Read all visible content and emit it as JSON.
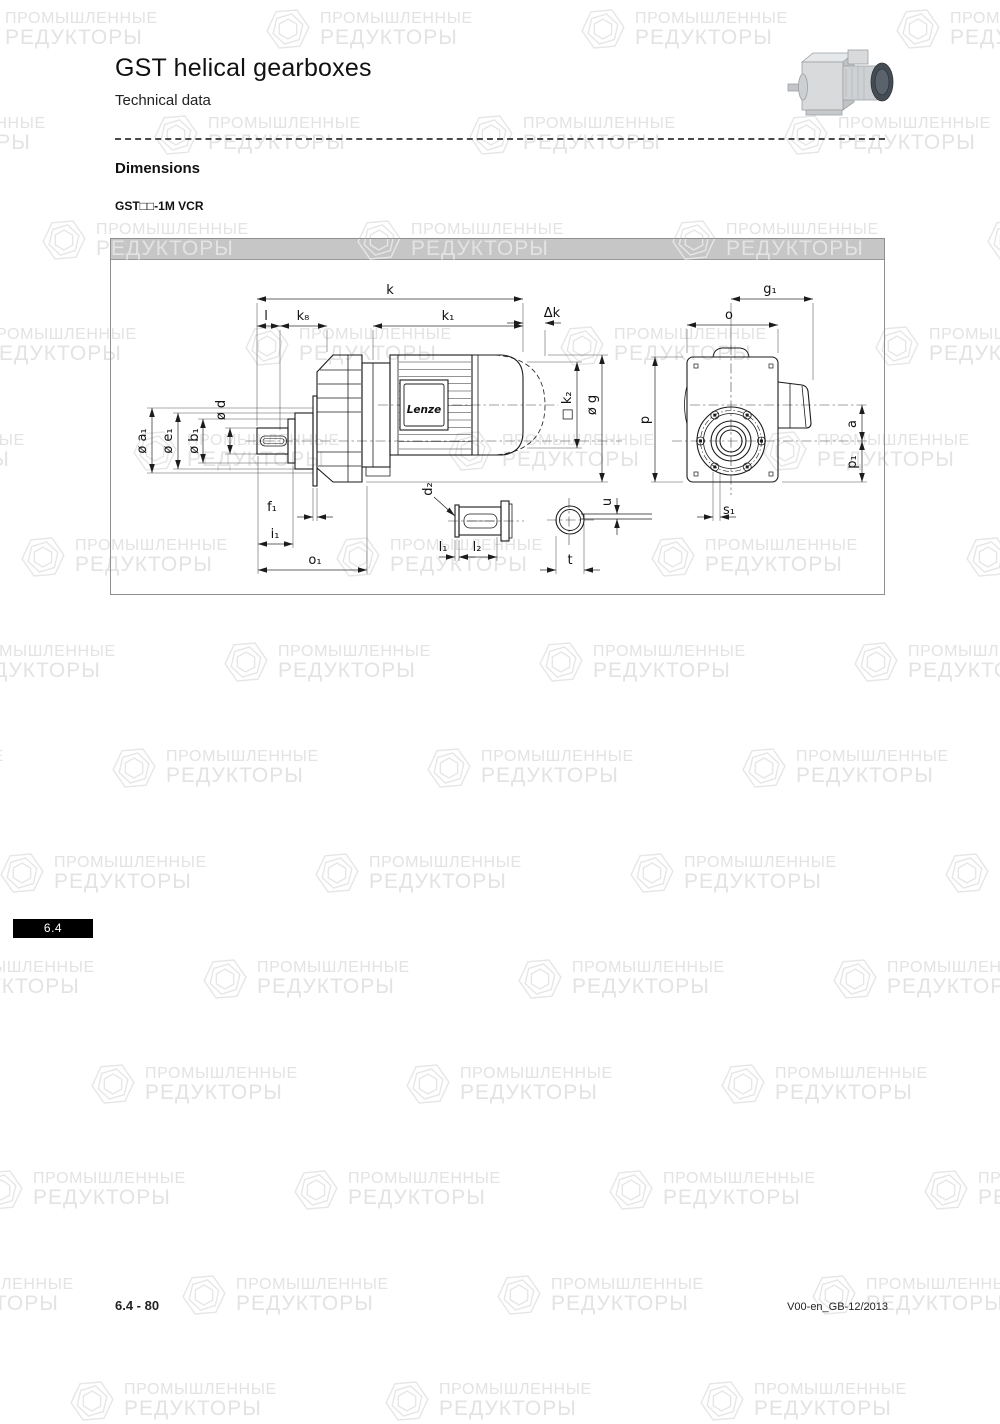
{
  "page": {
    "title": "GST helical gearboxes",
    "subtitle": "Technical data",
    "section_heading": "Dimensions",
    "model_label": "GST□□-1M VCR",
    "chapter_tab": "6.4",
    "footer_left": "6.4 - 80",
    "footer_right": "V00-en_GB-12/2013"
  },
  "watermark": {
    "line1": "ПРОМЫШЛЕННЫЕ",
    "line2": "РЕДУКТОРЫ"
  },
  "drawing": {
    "brand": "Lenze",
    "dim_labels": {
      "k": "k",
      "l": "l",
      "k8": "k₈",
      "k1": "k₁",
      "delta_k": "Δk",
      "d": "ø d",
      "a1": "ø a₁",
      "e1": "ø e₁",
      "b1": "ø b₁",
      "f1": "f₁",
      "i1": "i₁",
      "o1": "o₁",
      "k2": "□ k₂",
      "g": "ø g",
      "d2": "d₂",
      "l1": "l₁",
      "l2": "l₂",
      "t": "t",
      "u": "u",
      "g1": "g₁",
      "o": "o",
      "p": "p",
      "a": "a",
      "p1": "p₁",
      "s1": "s₁"
    }
  },
  "colors": {
    "panel_header_bg": "#c6c6c6",
    "panel_border": "#8f8f8f",
    "tab_bg": "#000000",
    "tab_text": "#ffffff",
    "watermark": "#e3e3e3",
    "line": "#1c1c1c"
  }
}
